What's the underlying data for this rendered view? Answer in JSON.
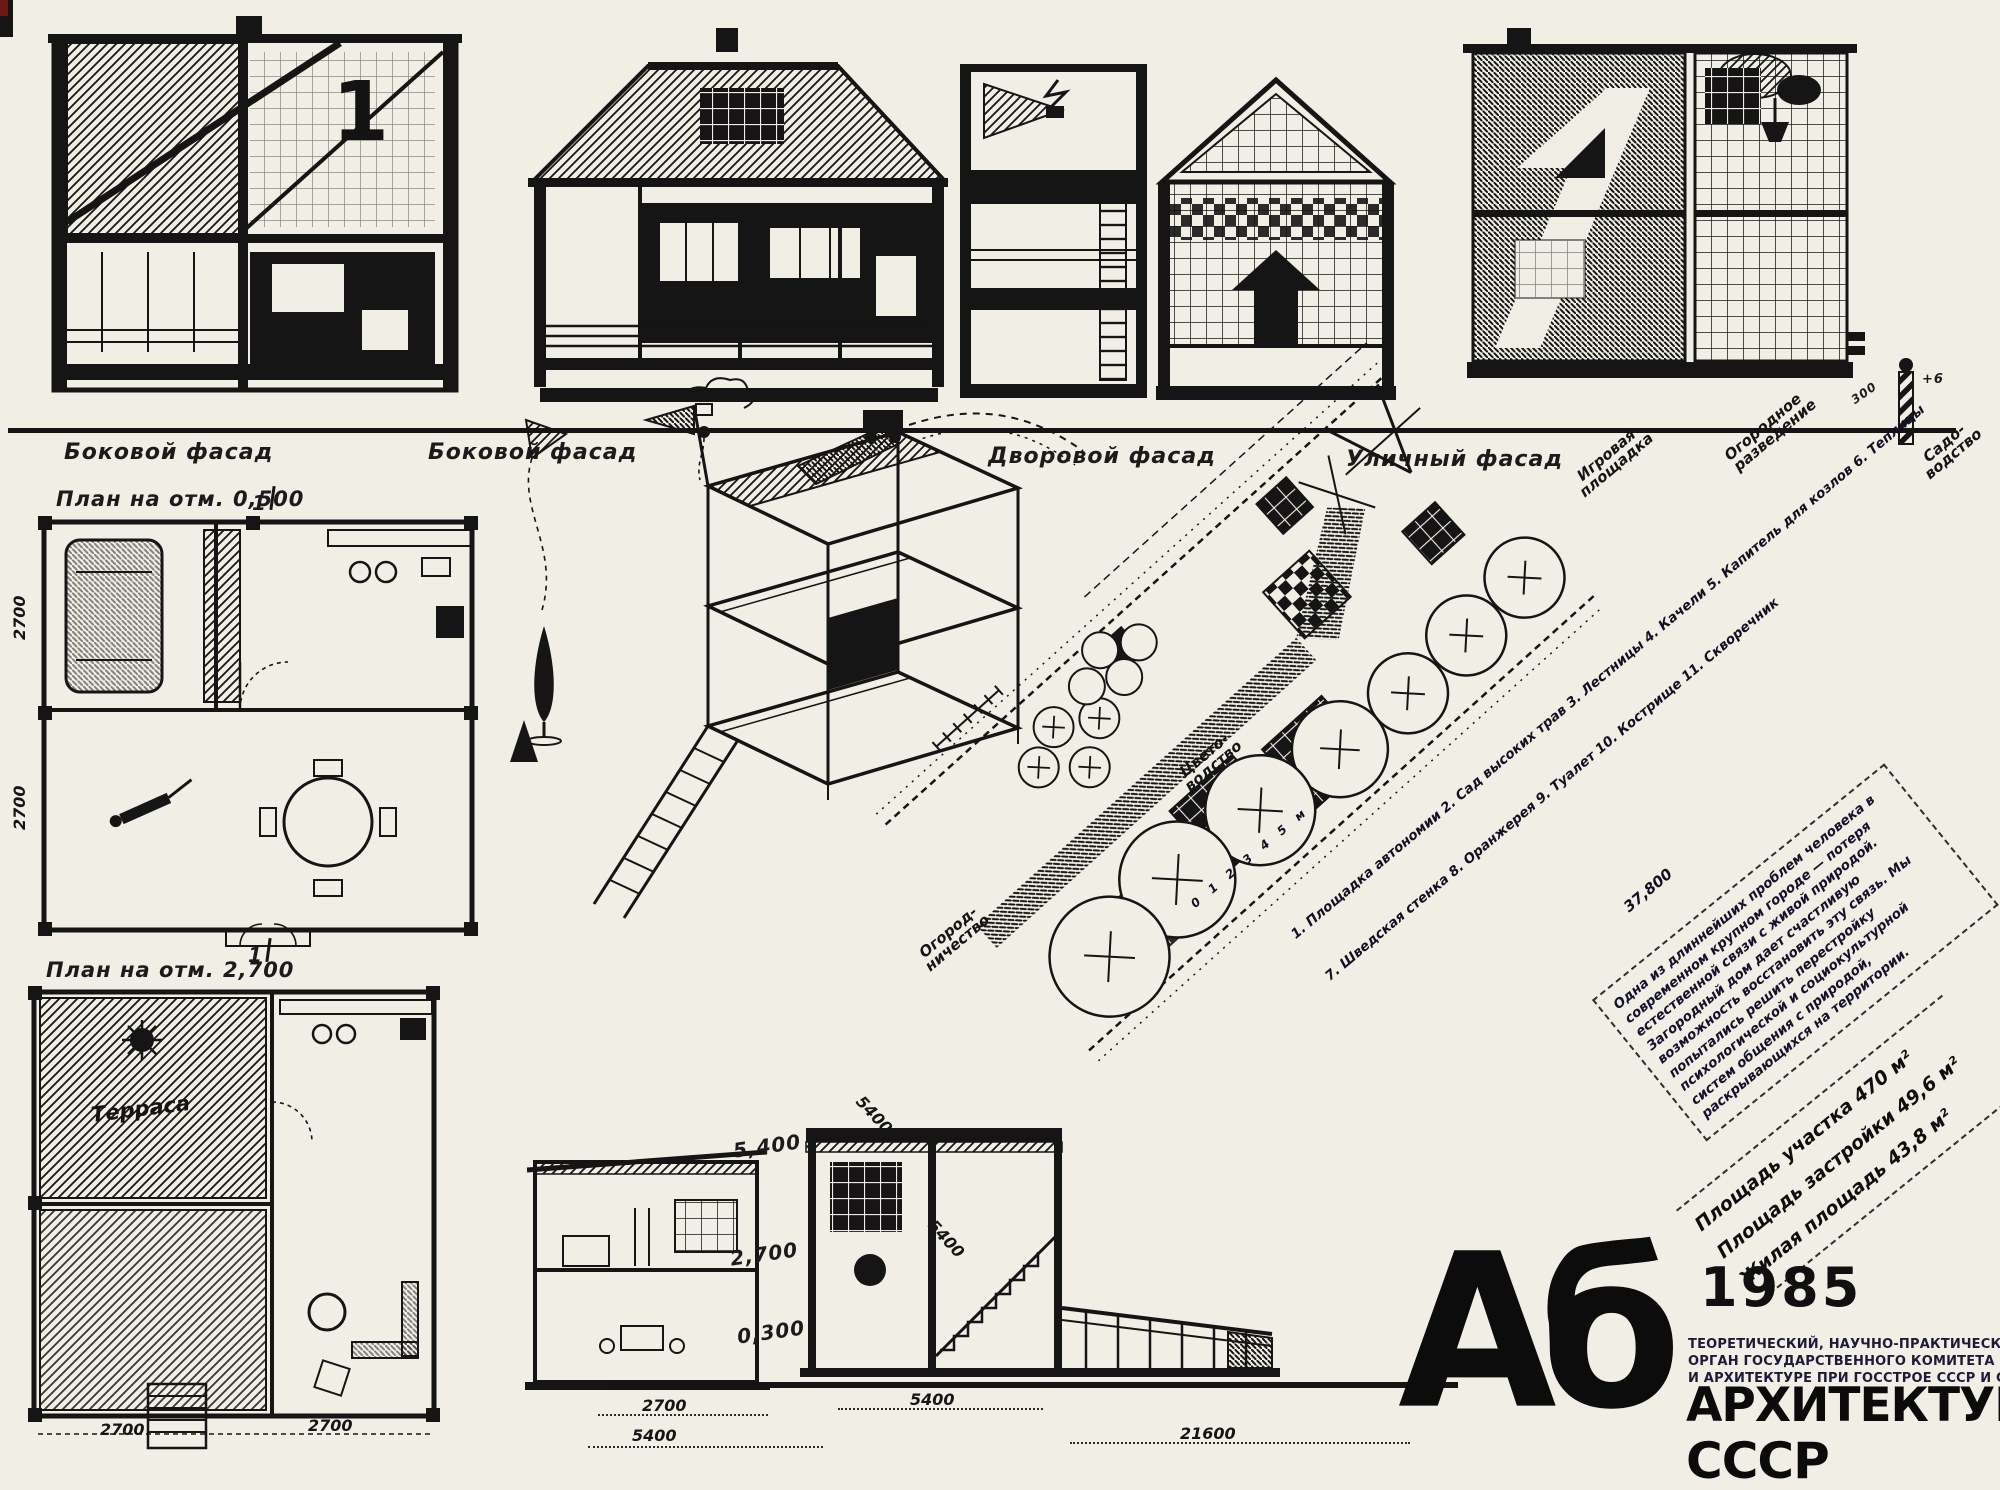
{
  "page": {
    "background": "#f1eee5",
    "ink": "#151515"
  },
  "facades": {
    "label_side_1": "Боковой фасад",
    "label_side_2": "Боковой фасад",
    "label_yard": "Дворовой фасад",
    "label_street": "Уличный фасад",
    "house_number": "1",
    "pole_top_mark": "+6",
    "pole_height_mark": "300"
  },
  "plans": {
    "plan1_title": "План на отм. 0,500",
    "plan2_title": "План на отм. 2,700",
    "terrace_label": "Терраса",
    "section_mark": "1",
    "plan1_dims": [
      "2700",
      "2700"
    ],
    "plan2_dims": [
      "2700",
      "2700"
    ]
  },
  "sections": {
    "levels": [
      "5,400",
      "2,700",
      "0,300"
    ],
    "dims": [
      "2700",
      "5400",
      "5400",
      "21600"
    ]
  },
  "site_plan": {
    "labels": [
      "Игровая площадка",
      "Огородное разведение",
      "Садо- водство",
      "Цвето- водство",
      "Огород- ничество"
    ],
    "scale_bar": "0 1 2 3 4 5 м",
    "dim_long": "37,800",
    "dim_side": [
      "5400",
      "5400"
    ],
    "legend": [
      "1. Площадка автономии   2. Сад высоких трав   3. Лестницы   4. Качели   5. Капитель для козлов   6. Теплицы",
      "7. Шведская стенка   8. Оранжерея   9. Туалет   10. Кострище   11. Скворечник"
    ],
    "note": "Одна из длиннейших проблем человека в современном крупном городе — потеря естественной связи с живой природой. Загородный дом дает счастливую возможность восстановить эту связь. Мы попытались решить перестройку психологической и социокультурной систем общения с природой, раскрывающихся на территории.",
    "areas": [
      "Площадь участка 470 м²",
      "Площадь застройки 49,6 м²",
      "Жилая площадь 43,8 м²"
    ]
  },
  "masthead": {
    "logo": "Аб",
    "year": "1985",
    "line1": "ТЕОРЕТИЧЕСКИЙ, НАУЧНО-ПРАКТИЧЕСКИЙ ЖУРНАЛ",
    "line2": "ОРГАН ГОСУДАРСТВЕННОГО КОМИТЕТА ПО ГРАЖДАН",
    "line3": "И АРХИТЕКТУРЕ ПРИ ГОССТРОЕ СССР И СОЮЗА АРХИТ",
    "title_big": "АРХИТЕКТУРА",
    "title_sub": "СССР"
  }
}
